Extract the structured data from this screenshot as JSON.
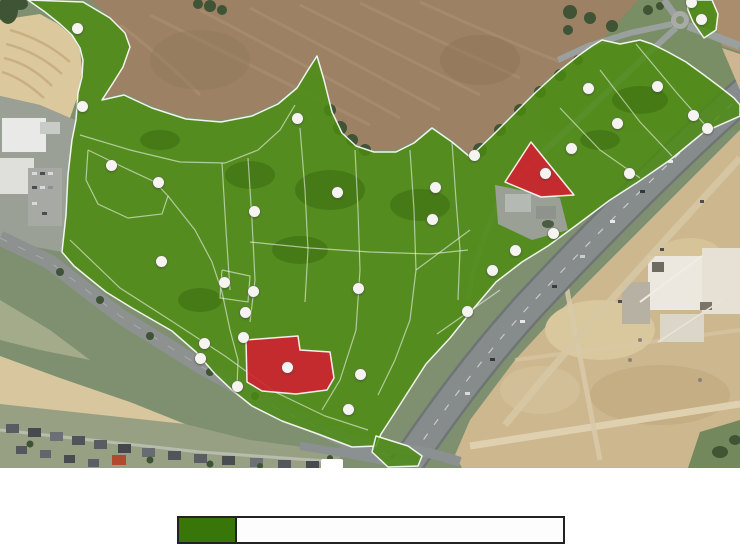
{
  "app": {
    "type": "interactive-parcel-availability-map"
  },
  "map": {
    "width": 740,
    "height": 468,
    "colors": {
      "available": "#4a8b0d",
      "occupied": "#d02030",
      "boundary": "#ffffff"
    },
    "zones": [
      {
        "id": "main-park",
        "status": "available",
        "points": [
          [
            28,
            0
          ],
          [
            83,
            2
          ],
          [
            110,
            18
          ],
          [
            125,
            33
          ],
          [
            130,
            47
          ],
          [
            123,
            67
          ],
          [
            113,
            83
          ],
          [
            102,
            100
          ],
          [
            124,
            95
          ],
          [
            152,
            108
          ],
          [
            186,
            119
          ],
          [
            221,
            122
          ],
          [
            252,
            116
          ],
          [
            278,
            104
          ],
          [
            297,
            88
          ],
          [
            308,
            70
          ],
          [
            317,
            56
          ],
          [
            324,
            80
          ],
          [
            332,
            112
          ],
          [
            342,
            133
          ],
          [
            356,
            146
          ],
          [
            374,
            152
          ],
          [
            396,
            152
          ],
          [
            414,
            143
          ],
          [
            432,
            128
          ],
          [
            452,
            142
          ],
          [
            470,
            157
          ],
          [
            492,
            136
          ],
          [
            514,
            114
          ],
          [
            536,
            92
          ],
          [
            558,
            72
          ],
          [
            578,
            56
          ],
          [
            592,
            46
          ],
          [
            602,
            40
          ],
          [
            620,
            44
          ],
          [
            640,
            40
          ],
          [
            652,
            44
          ],
          [
            668,
            52
          ],
          [
            686,
            62
          ],
          [
            704,
            75
          ],
          [
            720,
            87
          ],
          [
            734,
            98
          ],
          [
            740,
            105
          ],
          [
            740,
            116
          ],
          [
            704,
            132
          ],
          [
            670,
            160
          ],
          [
            638,
            182
          ],
          [
            610,
            200
          ],
          [
            578,
            224
          ],
          [
            548,
            246
          ],
          [
            522,
            262
          ],
          [
            496,
            282
          ],
          [
            474,
            308
          ],
          [
            450,
            338
          ],
          [
            426,
            364
          ],
          [
            408,
            392
          ],
          [
            394,
            414
          ],
          [
            381,
            434
          ],
          [
            376,
            446
          ],
          [
            352,
            447
          ],
          [
            318,
            434
          ],
          [
            282,
            421
          ],
          [
            252,
            406
          ],
          [
            232,
            390
          ],
          [
            215,
            374
          ],
          [
            196,
            352
          ],
          [
            172,
            331
          ],
          [
            132,
            308
          ],
          [
            106,
            292
          ],
          [
            74,
            266
          ],
          [
            62,
            252
          ],
          [
            66,
            215
          ],
          [
            68,
            175
          ],
          [
            72,
            140
          ],
          [
            76,
            120
          ],
          [
            78,
            93
          ],
          [
            82,
            77
          ],
          [
            83,
            60
          ],
          [
            80,
            48
          ],
          [
            72,
            35
          ],
          [
            60,
            24
          ],
          [
            45,
            12
          ]
        ]
      },
      {
        "id": "ne-corner",
        "status": "available",
        "points": [
          [
            687,
            0
          ],
          [
            712,
            0
          ],
          [
            718,
            14
          ],
          [
            716,
            30
          ],
          [
            704,
            38
          ],
          [
            693,
            22
          ],
          [
            688,
            10
          ]
        ]
      },
      {
        "id": "south-wedge",
        "status": "available",
        "points": [
          [
            376,
            436
          ],
          [
            408,
            446
          ],
          [
            422,
            456
          ],
          [
            418,
            466
          ],
          [
            388,
            467
          ],
          [
            372,
            452
          ]
        ]
      },
      {
        "id": "occupied-north",
        "status": "occupied",
        "points": [
          [
            531,
            142
          ],
          [
            505,
            182
          ],
          [
            541,
            197
          ],
          [
            574,
            195
          ]
        ]
      },
      {
        "id": "occupied-south",
        "status": "occupied",
        "points": [
          [
            246,
            340
          ],
          [
            298,
            336
          ],
          [
            300,
            350
          ],
          [
            330,
            352
          ],
          [
            334,
            378
          ],
          [
            327,
            390
          ],
          [
            296,
            394
          ],
          [
            262,
            391
          ],
          [
            247,
            382
          ]
        ]
      }
    ],
    "parcel_lines": [
      [
        [
          80,
          135
        ],
        [
          130,
          150
        ],
        [
          180,
          162
        ],
        [
          225,
          163
        ],
        [
          258,
          150
        ],
        [
          280,
          130
        ],
        [
          295,
          105
        ]
      ],
      [
        [
          88,
          150
        ],
        [
          125,
          168
        ],
        [
          155,
          182
        ],
        [
          168,
          196
        ],
        [
          162,
          214
        ],
        [
          128,
          218
        ],
        [
          98,
          204
        ],
        [
          86,
          180
        ],
        [
          88,
          150
        ]
      ],
      [
        [
          168,
          196
        ],
        [
          195,
          230
        ],
        [
          212,
          262
        ],
        [
          222,
          292
        ],
        [
          230,
          330
        ],
        [
          238,
          360
        ],
        [
          237,
          388
        ]
      ],
      [
        [
          70,
          240
        ],
        [
          120,
          288
        ],
        [
          170,
          320
        ],
        [
          225,
          356
        ],
        [
          275,
          392
        ],
        [
          325,
          416
        ],
        [
          368,
          430
        ]
      ],
      [
        [
          248,
          158
        ],
        [
          252,
          220
        ],
        [
          255,
          280
        ],
        [
          250,
          322
        ]
      ],
      [
        [
          300,
          128
        ],
        [
          305,
          190
        ],
        [
          308,
          250
        ],
        [
          305,
          302
        ]
      ],
      [
        [
          355,
          150
        ],
        [
          358,
          210
        ],
        [
          360,
          270
        ],
        [
          356,
          330
        ],
        [
          340,
          380
        ],
        [
          322,
          410
        ]
      ],
      [
        [
          410,
          150
        ],
        [
          414,
          210
        ],
        [
          416,
          270
        ],
        [
          410,
          320
        ],
        [
          395,
          360
        ],
        [
          378,
          395
        ]
      ],
      [
        [
          222,
          163
        ],
        [
          226,
          230
        ],
        [
          230,
          290
        ]
      ],
      [
        [
          250,
          242
        ],
        [
          310,
          248
        ],
        [
          370,
          252
        ],
        [
          430,
          254
        ],
        [
          468,
          250
        ]
      ],
      [
        [
          560,
          108
        ],
        [
          600,
          150
        ],
        [
          640,
          178
        ]
      ],
      [
        [
          600,
          70
        ],
        [
          640,
          122
        ],
        [
          672,
          156
        ]
      ],
      [
        [
          636,
          44
        ],
        [
          676,
          92
        ],
        [
          706,
          126
        ]
      ],
      [
        [
          222,
          270
        ],
        [
          250,
          276
        ],
        [
          248,
          302
        ],
        [
          220,
          298
        ],
        [
          222,
          270
        ]
      ],
      [
        [
          452,
          142
        ],
        [
          456,
          200
        ],
        [
          460,
          250
        ],
        [
          458,
          300
        ]
      ],
      [
        [
          437,
          334
        ],
        [
          500,
          290
        ]
      ],
      [
        [
          416,
          270
        ],
        [
          470,
          230
        ]
      ]
    ],
    "markers": [
      {
        "x": 77,
        "y": 28
      },
      {
        "x": 82,
        "y": 106
      },
      {
        "x": 111,
        "y": 165
      },
      {
        "x": 158,
        "y": 182
      },
      {
        "x": 254,
        "y": 211
      },
      {
        "x": 297,
        "y": 118
      },
      {
        "x": 337,
        "y": 192
      },
      {
        "x": 161,
        "y": 261
      },
      {
        "x": 224,
        "y": 282
      },
      {
        "x": 253,
        "y": 291
      },
      {
        "x": 245,
        "y": 312
      },
      {
        "x": 243,
        "y": 337
      },
      {
        "x": 204,
        "y": 343
      },
      {
        "x": 200,
        "y": 358
      },
      {
        "x": 287,
        "y": 367
      },
      {
        "x": 237,
        "y": 386
      },
      {
        "x": 358,
        "y": 288
      },
      {
        "x": 360,
        "y": 374
      },
      {
        "x": 348,
        "y": 409
      },
      {
        "x": 492,
        "y": 270
      },
      {
        "x": 467,
        "y": 311
      },
      {
        "x": 691,
        "y": 2
      },
      {
        "x": 701,
        "y": 19
      },
      {
        "x": 588,
        "y": 88
      },
      {
        "x": 657,
        "y": 86
      },
      {
        "x": 617,
        "y": 123
      },
      {
        "x": 693,
        "y": 115
      },
      {
        "x": 707,
        "y": 128
      },
      {
        "x": 571,
        "y": 148
      },
      {
        "x": 545,
        "y": 173
      },
      {
        "x": 629,
        "y": 173
      },
      {
        "x": 474,
        "y": 155
      },
      {
        "x": 435,
        "y": 187
      },
      {
        "x": 432,
        "y": 219
      },
      {
        "x": 553,
        "y": 233
      },
      {
        "x": 515,
        "y": 250
      }
    ]
  },
  "legend": {
    "swatch_color": "#38760a",
    "border_color": "#222222"
  }
}
